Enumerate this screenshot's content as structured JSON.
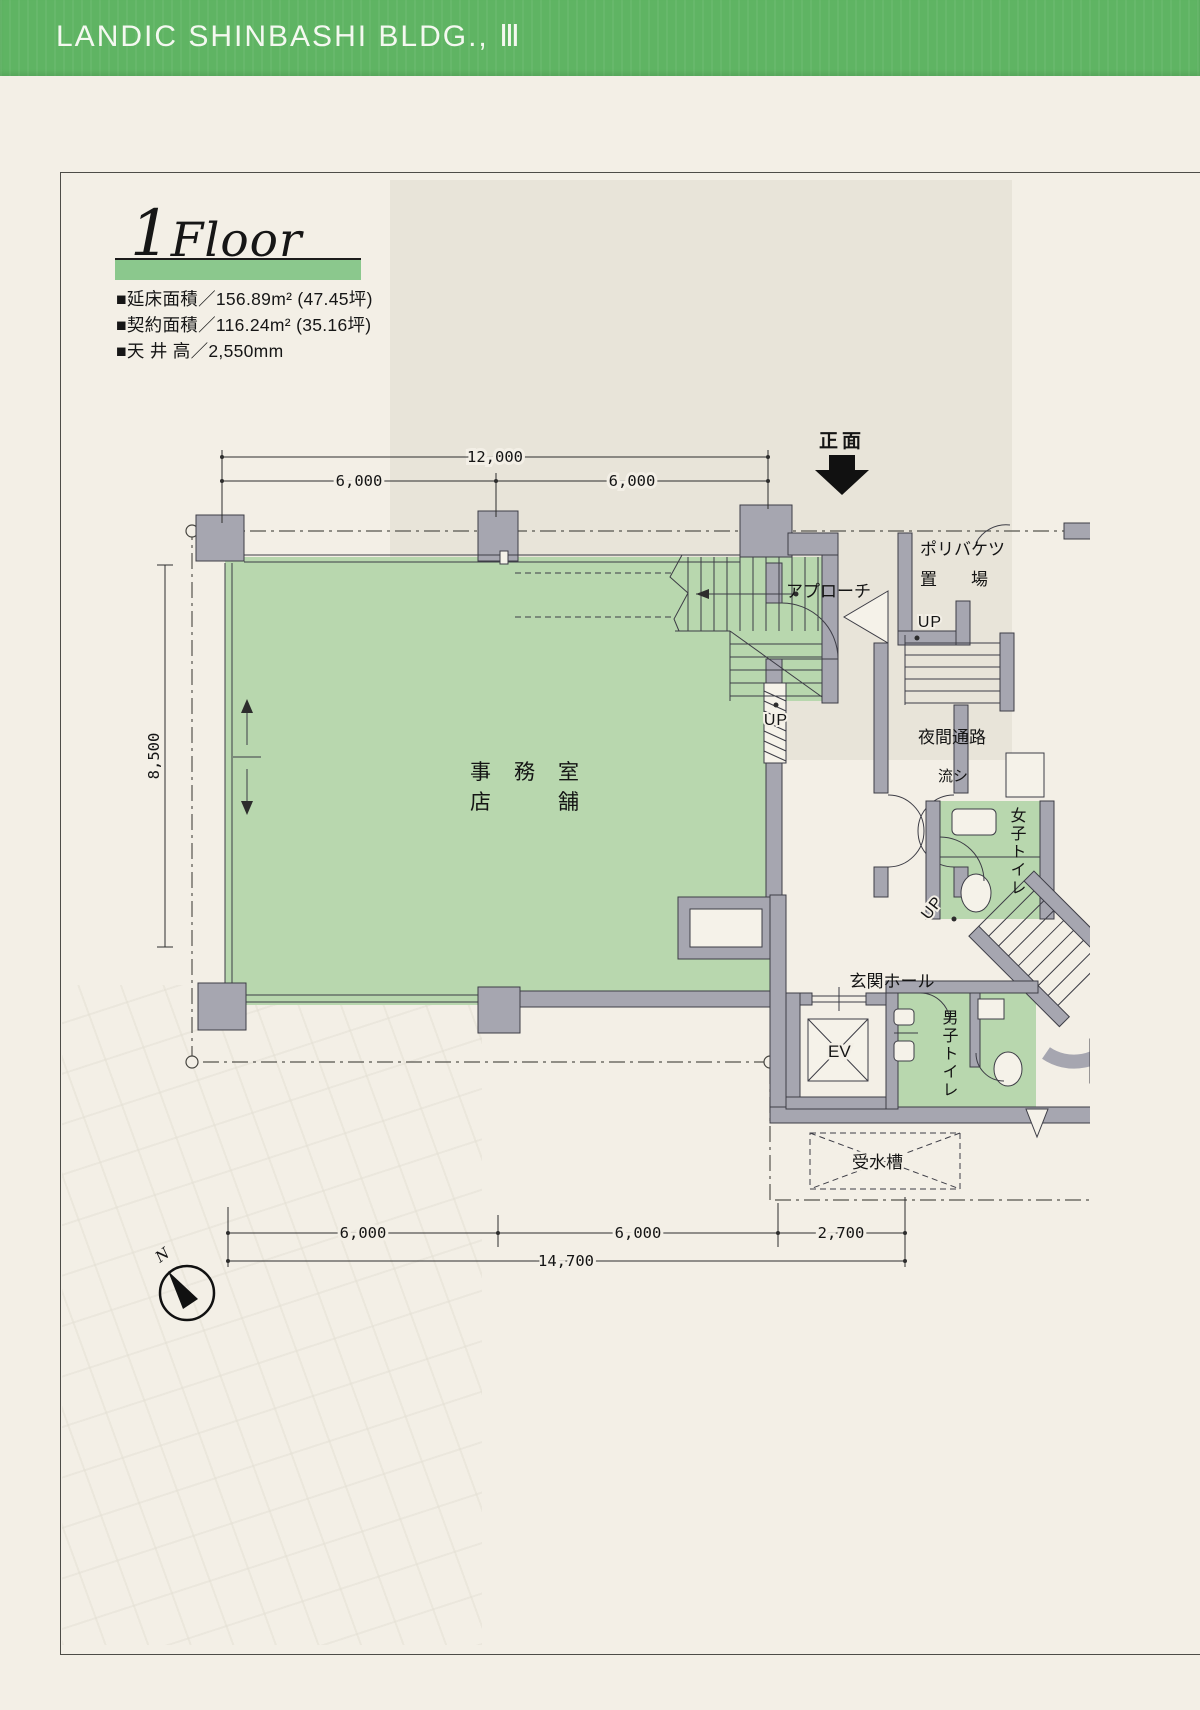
{
  "header": {
    "title": "LANDIC SHINBASHI BLDG., Ⅲ",
    "bg_color": "#5fb463"
  },
  "floor_section": {
    "floor_number": "1",
    "floor_word": "Floor",
    "bar_color": "#8bc88d",
    "specs": [
      "■延床面積／156.89m² (47.45坪)",
      "■契約面積／116.24m² (35.16坪)",
      "■天 井 高／2,550mm"
    ]
  },
  "plan": {
    "colors": {
      "room_green": "#b8d7ae",
      "wall_gray": "#a6a6b0"
    },
    "dims": {
      "top_total": "12,000",
      "top_left": "6,000",
      "top_right": "6,000",
      "left_height": "8,500",
      "bottom_a": "6,000",
      "bottom_b": "6,000",
      "bottom_c": "2,700",
      "bottom_total": "14,700"
    },
    "labels": {
      "front": "正面",
      "approach": "アプローチ",
      "bucket_line1": "ポリバケツ",
      "bucket_line2": "置　　場",
      "office": "事　務　室",
      "shop": "店　　　舗",
      "night_passage": "夜間通路",
      "sink": "流シ",
      "womens_toilet": "女子トイレ",
      "entrance_hall": "玄関ホール",
      "elevator": "EV",
      "mens_toilet": "男子トイレ",
      "water_tank": "受水槽",
      "up": "UP",
      "north": "N"
    }
  }
}
